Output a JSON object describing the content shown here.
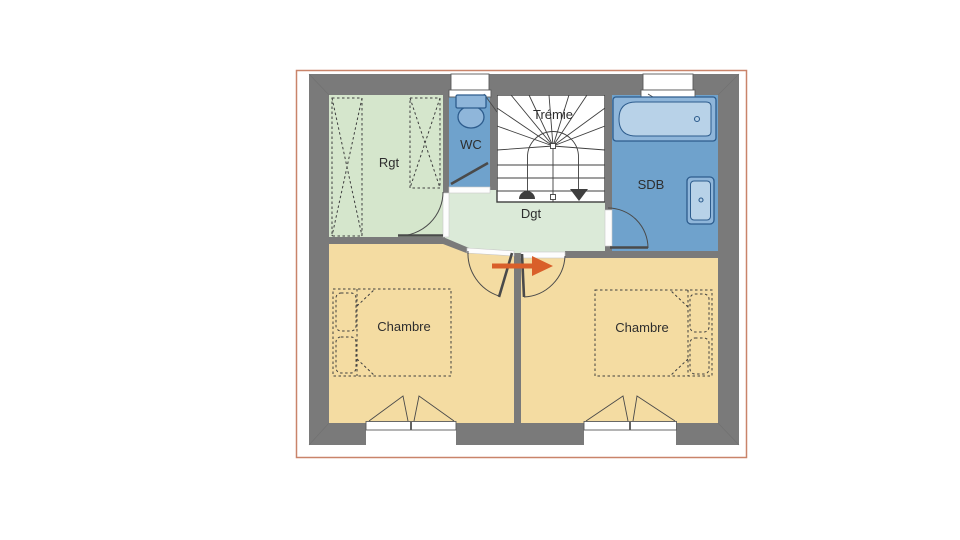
{
  "plan": {
    "type": "floor-plan",
    "labels": {
      "storage": "Rgt",
      "wc": "WC",
      "stairwell": "Trémie",
      "bathroom": "SDB",
      "hallway": "Dgt",
      "bedroom_left": "Chambre",
      "bedroom_right": "Chambre"
    },
    "fixtures": [
      "wardrobe",
      "wardrobe",
      "toilet",
      "staircase",
      "bathtub",
      "washbasin",
      "double-bed",
      "double-bed",
      "doors",
      "windows",
      "direction-arrow"
    ]
  },
  "colors": {
    "wall": "#7a7a7a",
    "wet-room": "#6fa2cc",
    "storage": "#d5e6cc",
    "hallway": "#dbead8",
    "bedroom": "#f4dca2",
    "line": "#3f3f3f",
    "fixture-stroke": "#2d5c8d",
    "fixture-fill": "#8fb6da",
    "fixture-inner": "#b8d2e8",
    "arrow": "#d95f2a",
    "frame": "#c9846a"
  }
}
